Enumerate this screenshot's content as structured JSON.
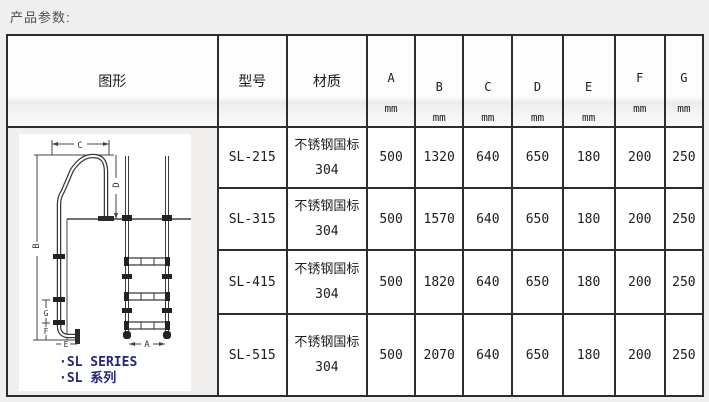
{
  "page": {
    "title": "产品参数:"
  },
  "table": {
    "headers": {
      "figure": "图形",
      "model": "型号",
      "material": "材质"
    },
    "dim_columns": [
      {
        "letter": "A",
        "unit": "mm"
      },
      {
        "letter": "B",
        "unit": "mm"
      },
      {
        "letter": "C",
        "unit": "mm"
      },
      {
        "letter": "D",
        "unit": "mm"
      },
      {
        "letter": "E",
        "unit": "mm"
      },
      {
        "letter": "F",
        "unit": "mm"
      },
      {
        "letter": "G",
        "unit": "mm"
      }
    ],
    "rows": [
      {
        "model": "SL-215",
        "material": "不锈钢国标 304",
        "A": "500",
        "B": "1320",
        "C": "640",
        "D": "650",
        "E": "180",
        "F": "200",
        "G": "250"
      },
      {
        "model": "SL-315",
        "material": "不锈钢国标 304",
        "A": "500",
        "B": "1570",
        "C": "640",
        "D": "650",
        "E": "180",
        "F": "200",
        "G": "250"
      },
      {
        "model": "SL-415",
        "material": "不锈钢国标 304",
        "A": "500",
        "B": "1820",
        "C": "640",
        "D": "650",
        "E": "180",
        "F": "200",
        "G": "250"
      },
      {
        "model": "SL-515",
        "material": "不锈钢国标 304",
        "A": "500",
        "B": "2070",
        "C": "640",
        "D": "650",
        "E": "180",
        "F": "200",
        "G": "250"
      }
    ]
  },
  "diagram": {
    "labels": {
      "A": "A",
      "B": "B",
      "C": "C",
      "D": "D",
      "E": "E",
      "F": "F",
      "G": "G"
    },
    "caption_en": "·SL SERIES",
    "caption_zh": "·SL 系列",
    "caption_color": "#24247f",
    "line_color": "#3a3a3a"
  }
}
